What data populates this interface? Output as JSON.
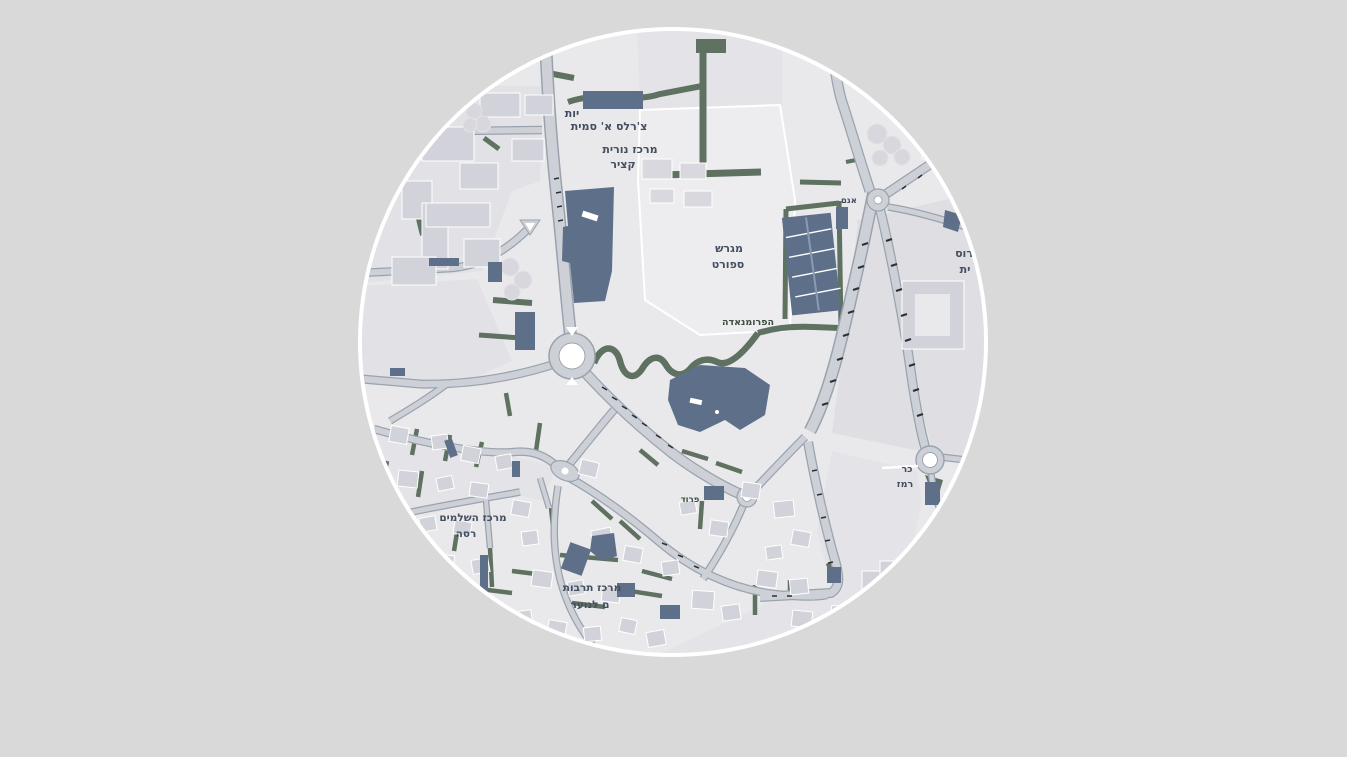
{
  "page": {
    "background_color": "#d9d9d9"
  },
  "viewport": {
    "shape": "circle",
    "border_color": "#ffffff",
    "diameter_px": 622,
    "center_x_px": 673,
    "center_y_px": 342
  },
  "map": {
    "language": "he",
    "kind": "street-map",
    "colors": {
      "map_background": "#e9e9ec",
      "road_fill": "#cdd1d7",
      "road_casing": "#9aa3ad",
      "building_light": "#d2d3da",
      "building_dark": "#5e7089",
      "vegetation": "#5f7161",
      "urban_block": "#e1e1e6",
      "label_text": "#434e60",
      "vegetation_label_text": "#3f4e41"
    },
    "labels": [
      {
        "id": "school-fragment",
        "text": "יות"
      },
      {
        "id": "school-name",
        "text": "צ'רלס א' סמית"
      },
      {
        "id": "nurit-center-line1",
        "text": "מרכז נורית"
      },
      {
        "id": "nurit-center-line2",
        "text": "קציר"
      },
      {
        "id": "sports-field-line1",
        "text": "מגרש"
      },
      {
        "id": "sports-field-line2",
        "text": "ספורט"
      },
      {
        "id": "promenade",
        "text": "הפרומנאדה"
      },
      {
        "id": "edge-right-line1",
        "text": "רוס"
      },
      {
        "id": "edge-right-line2",
        "text": "ית"
      },
      {
        "id": "tiny-junction-label",
        "text": "אנם"
      },
      {
        "id": "shlamim-center-line1",
        "text": "מרכז השלמים"
      },
      {
        "id": "shlamim-center-line2",
        "text": "רסה"
      },
      {
        "id": "culture-center-line1",
        "text": "מרכז תרבות"
      },
      {
        "id": "culture-center-line2",
        "text": "ם לנוער"
      },
      {
        "id": "ramez-square-line1",
        "text": "כר"
      },
      {
        "id": "ramez-square-line2",
        "text": "רמז"
      },
      {
        "id": "garden-label",
        "text": "פרוד"
      }
    ]
  }
}
